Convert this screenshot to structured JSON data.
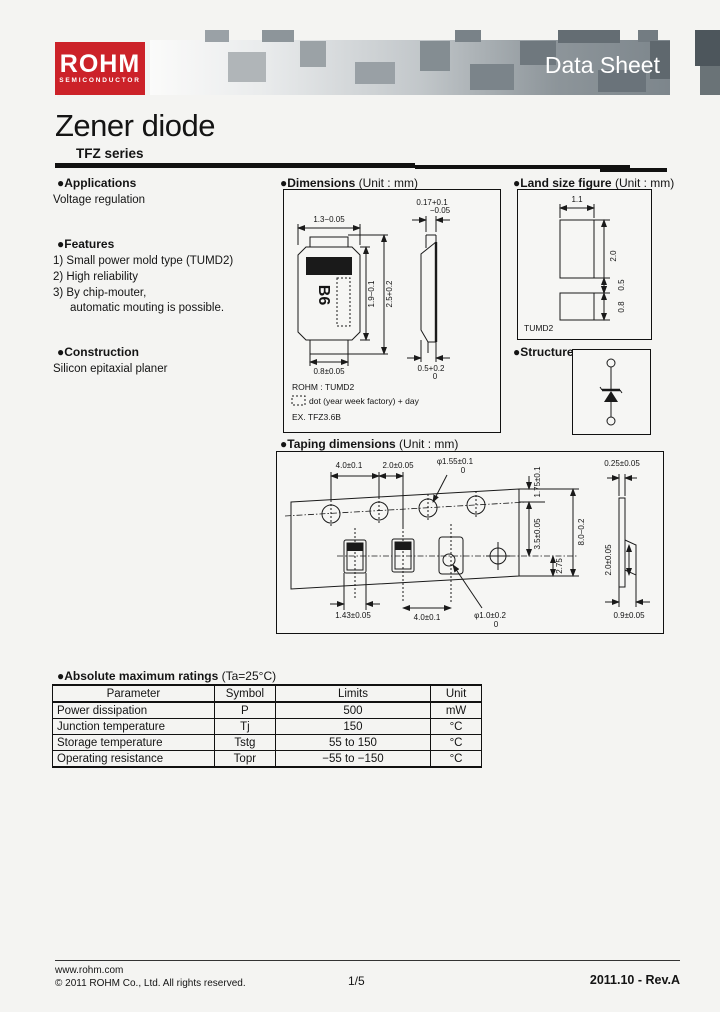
{
  "header": {
    "logo_brand": "ROHM",
    "logo_sub": "SEMICONDUCTOR",
    "banner_label": "Data Sheet"
  },
  "page": {
    "title_main": "Zener diode",
    "title_series": "TFZ series"
  },
  "applications": {
    "heading": "●Applications",
    "body": "Voltage regulation"
  },
  "features": {
    "heading": "●Features",
    "item1": "1) Small power mold type (TUMD2)",
    "item2": "2) High reliability",
    "item3": "3) By chip-mouter,",
    "item4": "automatic mouting is possible."
  },
  "construction": {
    "heading": "●Construction",
    "body": "Silicon epitaxial planer"
  },
  "dimensions": {
    "heading": "●Dimensions",
    "unit": "(Unit : mm)",
    "marking": "B6",
    "front_width": "1.3−0.05",
    "body_length": "1.9−0.1",
    "total_length": "2.5+0.2",
    "lead_width": "0.8±0.05",
    "side_top_tol_a": "0.17+0.1",
    "side_top_tol_b": "−0.05",
    "side_thickness_a": "0.5+0.2",
    "side_thickness_b": "0",
    "note_package": "ROHM : TUMD2",
    "note_dot": "dot (year week factory) + day",
    "note_example": "EX.  TFZ3.6B"
  },
  "land": {
    "heading": "●Land size figure",
    "unit": "(Unit : mm)",
    "width": "1.1",
    "length": "2.0",
    "gap": "0.5",
    "pad": "0.8",
    "caption": "TUMD2"
  },
  "structure": {
    "heading": "●Structure"
  },
  "taping": {
    "heading": "●Taping dimensions",
    "unit": "(Unit : mm)",
    "hole_pitch": "4.0±0.1",
    "hole_to_pocket": "2.0±0.05",
    "hole_dia": "φ1.55±0.1",
    "hole_dia_tol": "0",
    "edge_to_hole": "1.75±0.1",
    "hole_to_center": "3.5±0.05",
    "tape_width": "8.0−0.2",
    "bottom_margin": "2.75",
    "pocket_width": "1.43±0.05",
    "pocket_pitch": "4.0±0.1",
    "pocket_hole_dia": "φ1.0±0.2",
    "pocket_hole_tol": "0",
    "tape_thickness": "0.25±0.05",
    "pocket_length": "2.0±0.05",
    "pocket_depth": "0.9±0.05"
  },
  "ratings": {
    "heading": "●Absolute maximum ratings",
    "condition": "(Ta=25°C)",
    "columns": [
      "Parameter",
      "Symbol",
      "Limits",
      "Unit"
    ],
    "rows": [
      [
        "Power dissipation",
        "P",
        "500",
        "mW"
      ],
      [
        "Junction temperature",
        "Tj",
        "150",
        "°C"
      ],
      [
        "Storage temperature",
        "Tstg",
        "55 to  150",
        "°C"
      ],
      [
        "Operating resistance",
        "Topr",
        "−55 to −150",
        "°C"
      ]
    ]
  },
  "footer": {
    "site": "www.rohm.com",
    "copyright": "© 2011  ROHM Co., Ltd. All rights reserved.",
    "page_number": "1/5",
    "revision": "2011.10 -  Rev.A"
  }
}
